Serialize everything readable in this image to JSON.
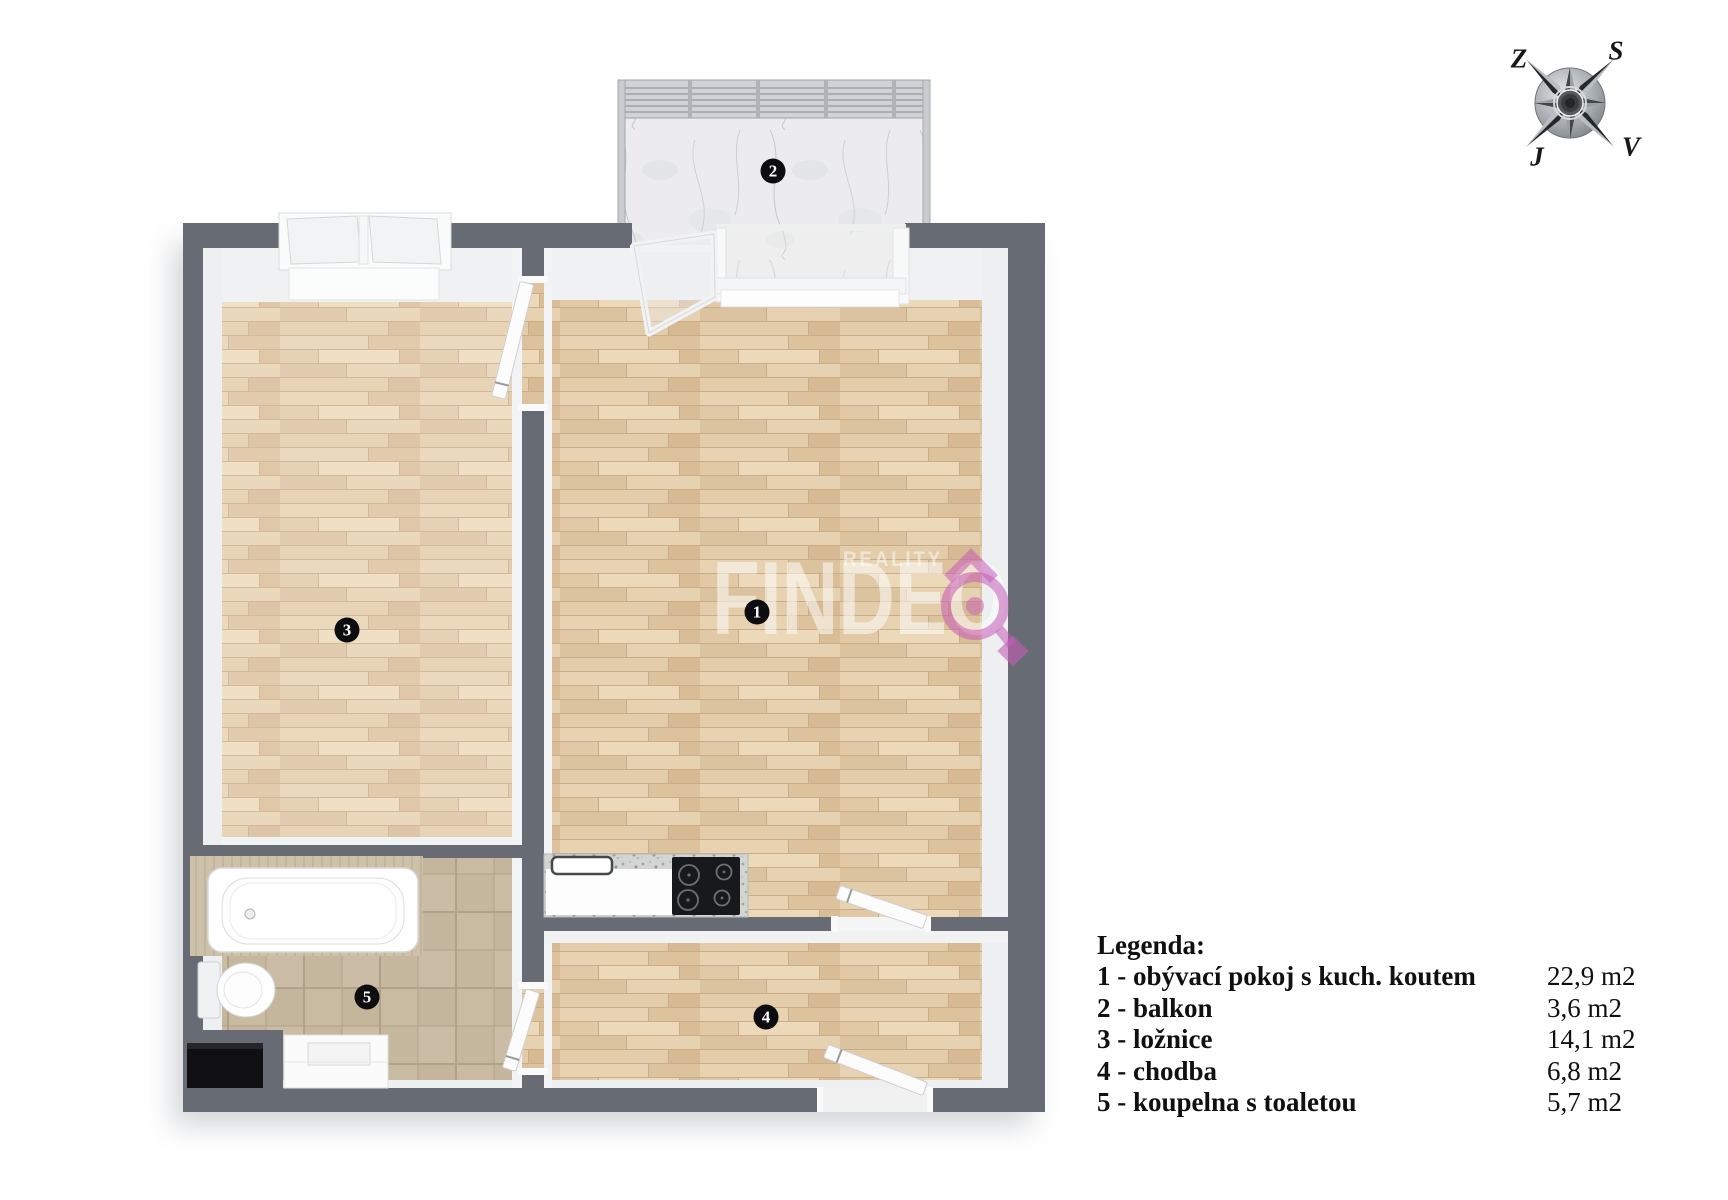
{
  "watermark": {
    "tagline": "REALITY",
    "brand": "FINDEO",
    "accent_color": "#c65bb6",
    "text_color": "#ffffff"
  },
  "compass": {
    "west": "Z",
    "north": "S",
    "south": "J",
    "east": "V"
  },
  "room_markers": {
    "living": "1",
    "balcony": "2",
    "bedroom": "3",
    "hallway": "4",
    "bathroom": "5"
  },
  "legend": {
    "title": "Legenda:",
    "rows": [
      {
        "label": "1 - obývací pokoj s kuch. koutem",
        "area": "22,9 m2"
      },
      {
        "label": "2 - balkon",
        "area": "3,6 m2"
      },
      {
        "label": "3 - ložnice",
        "area": "14,1 m2"
      },
      {
        "label": "4 - chodba",
        "area": "6,8 m2"
      },
      {
        "label": "5 - koupelna s toaletou",
        "area": "5,7 m2"
      }
    ]
  },
  "colors": {
    "wall": "#676c74",
    "wood_floor": "#e3cdac",
    "tile_floor": "#c8baa2",
    "balcony_floor": "#ededee"
  }
}
